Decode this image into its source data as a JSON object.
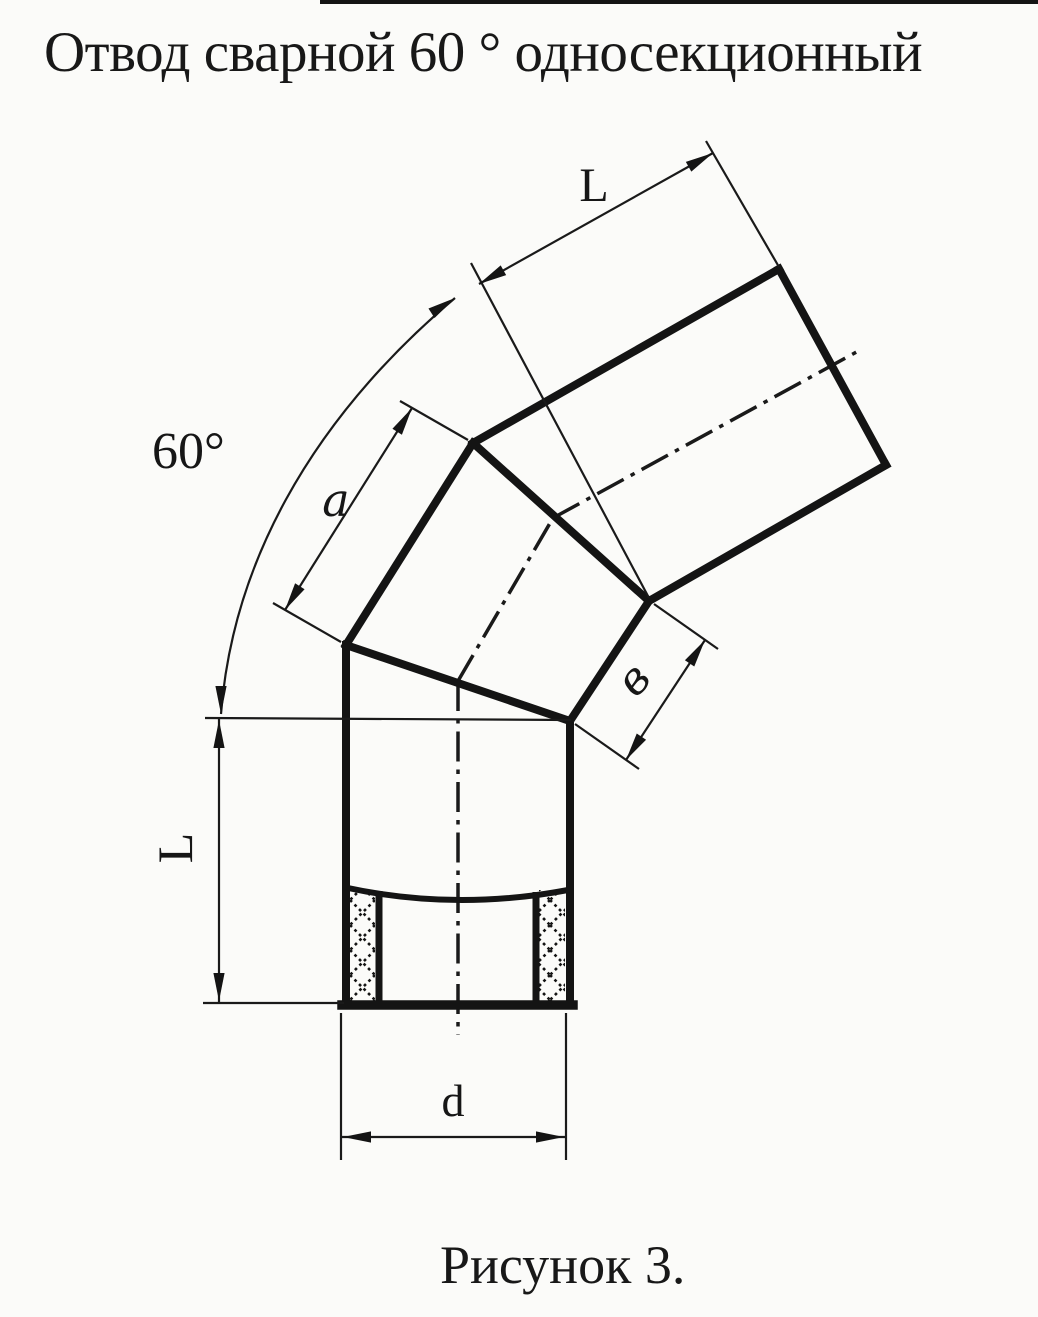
{
  "title": "Отвод сварной 60 ° односекционный",
  "caption": "Рисунок 3.",
  "labels": {
    "top_length": "L",
    "angle": "60°",
    "middle_length": "а",
    "seam_width": "в",
    "left_length": "L",
    "diameter": "d"
  },
  "colors": {
    "ink": "#141414",
    "paper": "#fbfbf9"
  }
}
